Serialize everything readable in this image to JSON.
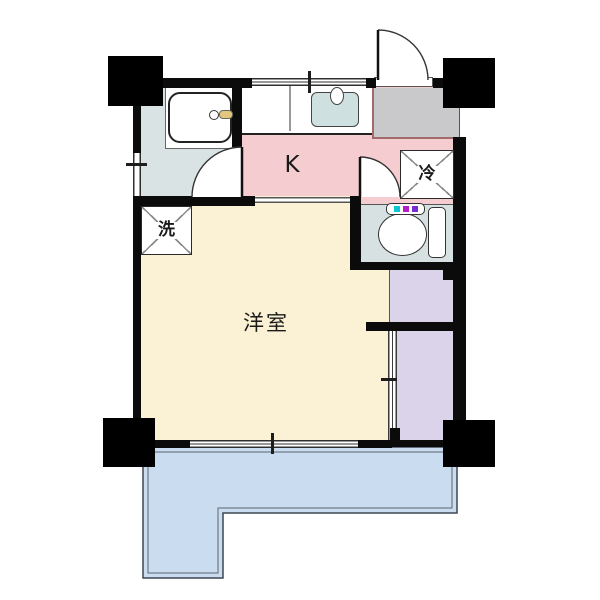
{
  "title": "apartment-floor-plan",
  "labels": {
    "kitchen": "K",
    "main_room": "洋室",
    "washer": "洗",
    "refrigerator": "冷"
  },
  "colors": {
    "kitchen_floor": "#F5CDD1",
    "main_room_floor": "#FBF1D4",
    "bathroom_floor": "#D9E3E3",
    "toilet_floor": "#D7E1E1",
    "closet": "#DAD3EA",
    "balcony": "#CADCEF",
    "entry_floor": "#C9C9CB",
    "sink": "#CEE0DF",
    "bathtub": "#FFFFFF",
    "bath_faucet": "#E3C77D",
    "wall": "#0B0B0B",
    "entry_step_line": "#A36A6A",
    "toilet_buttons": [
      "#0CC6D4",
      "#B41FC8",
      "#7B2BD2"
    ]
  }
}
